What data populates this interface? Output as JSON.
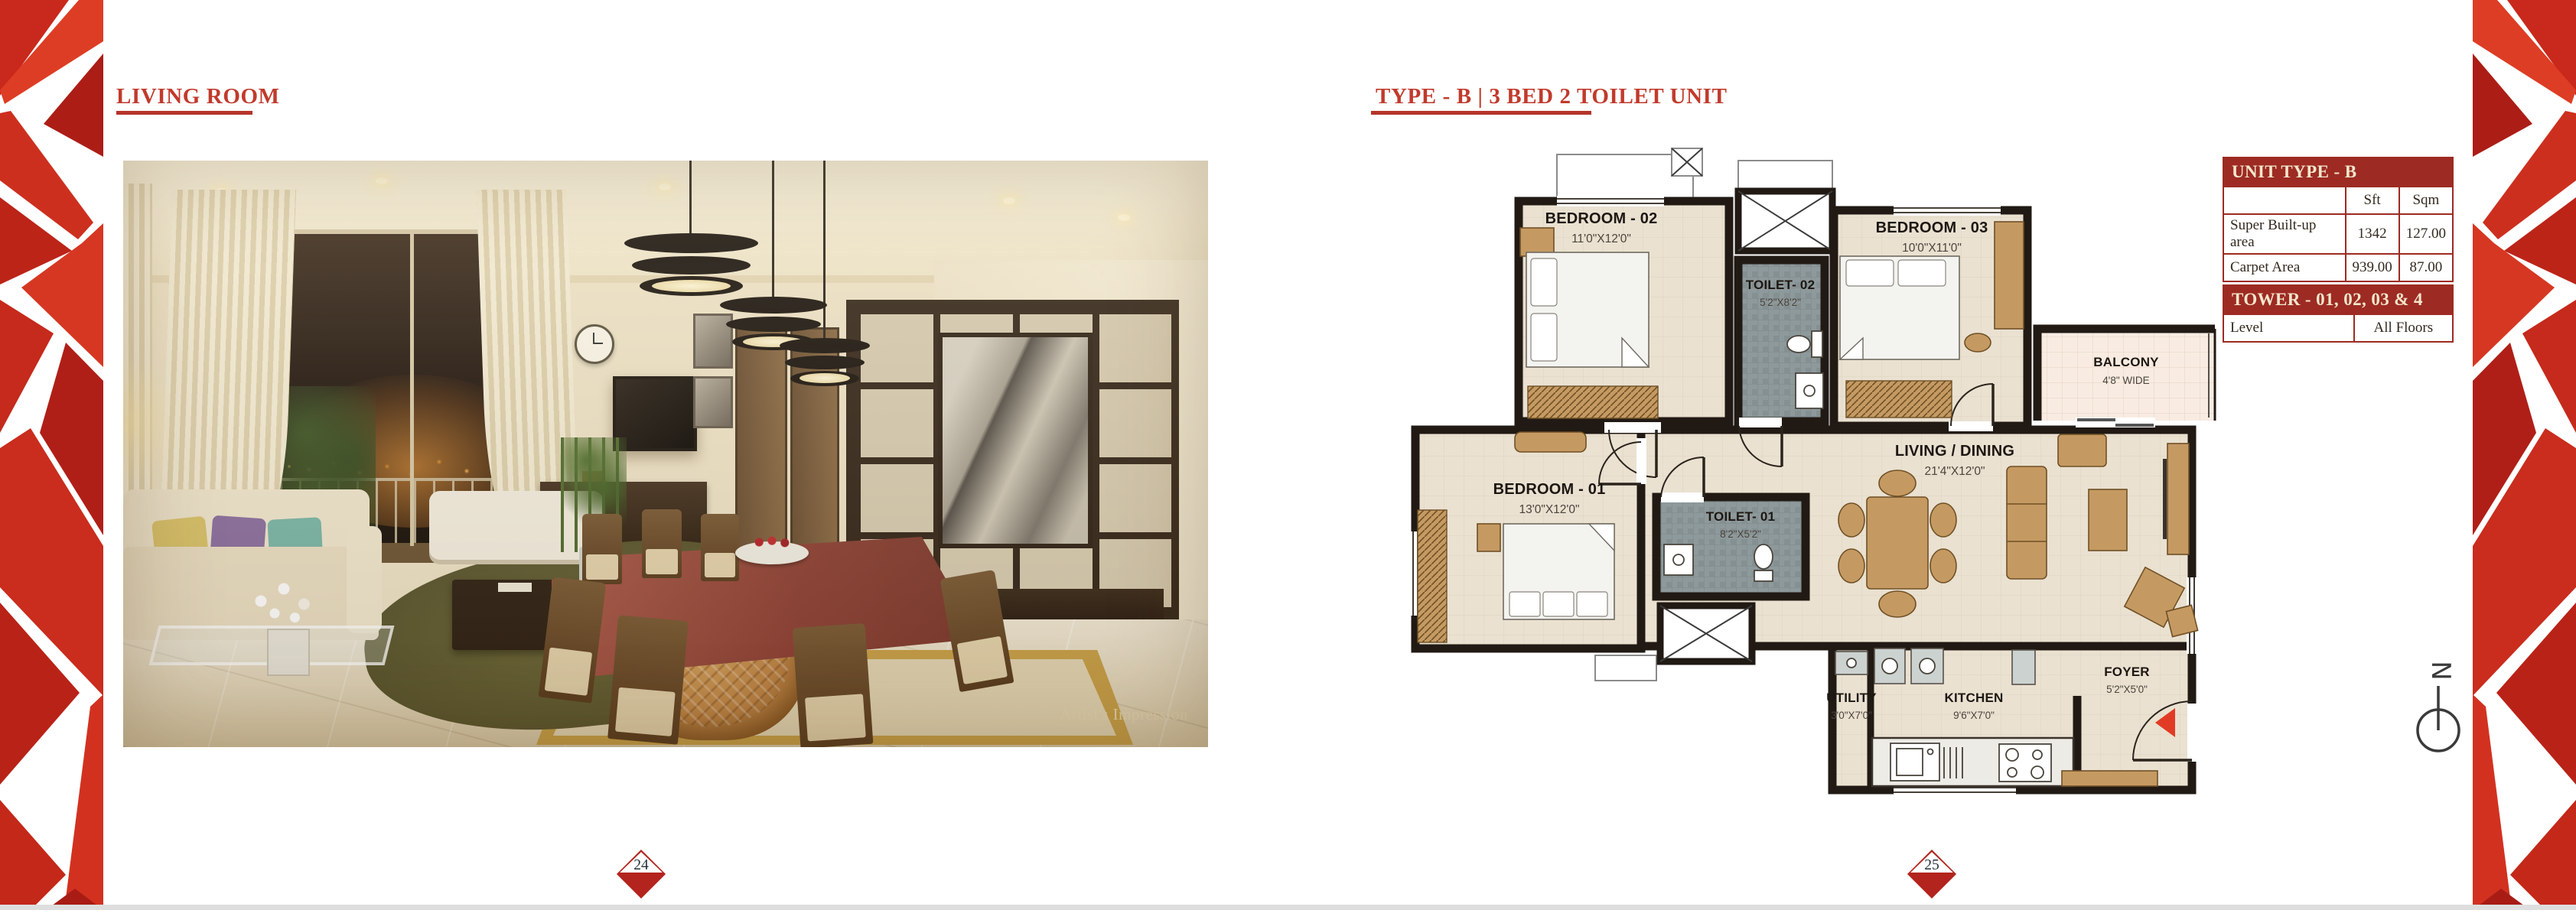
{
  "left_page": {
    "title": "LIVING ROOM",
    "photo_caption": "Artist's Impression",
    "page_marker": "24"
  },
  "right_page": {
    "title": "TYPE - B | 3 BED 2 TOILET UNIT",
    "page_marker": "25",
    "north_label": "N",
    "unit_table": {
      "header": "UNIT TYPE - B",
      "columns": [
        "",
        "Sft",
        "Sqm"
      ],
      "rows": [
        {
          "label": "Super Built-up area",
          "sft": "1342",
          "sqm": "127.00"
        },
        {
          "label": "Carpet Area",
          "sft": "939.00",
          "sqm": "87.00"
        }
      ]
    },
    "tower_table": {
      "header": "TOWER - 01, 02, 03 & 4",
      "level_label": "Level",
      "level_value": "All Floors"
    },
    "plan": {
      "rooms": [
        {
          "label": "BEDROOM - 02",
          "dims": "11'0\"X12'0\""
        },
        {
          "label": "TOILET- 02",
          "dims": "5'2\"X8'2\""
        },
        {
          "label": "BEDROOM - 03",
          "dims": "10'0\"X11'0\""
        },
        {
          "label": "BALCONY",
          "dims": "4'8\" WIDE"
        },
        {
          "label": "LIVING / DINING",
          "dims": "21'4\"X12'0\""
        },
        {
          "label": "BEDROOM - 01",
          "dims": "13'0\"X12'0\""
        },
        {
          "label": "TOILET- 01",
          "dims": "8'2\"X5'2\""
        },
        {
          "label": "UTILITY",
          "dims": "3'0\"X7'0\""
        },
        {
          "label": "KITCHEN",
          "dims": "9'6\"X7'0\""
        },
        {
          "label": "FOYER",
          "dims": "5'2\"X5'0\""
        }
      ]
    },
    "colors": {
      "accent_red": "#c13a2c",
      "table_red": "#9d2b23",
      "marker_red": "#b3241e",
      "wall": "#211a14"
    }
  }
}
